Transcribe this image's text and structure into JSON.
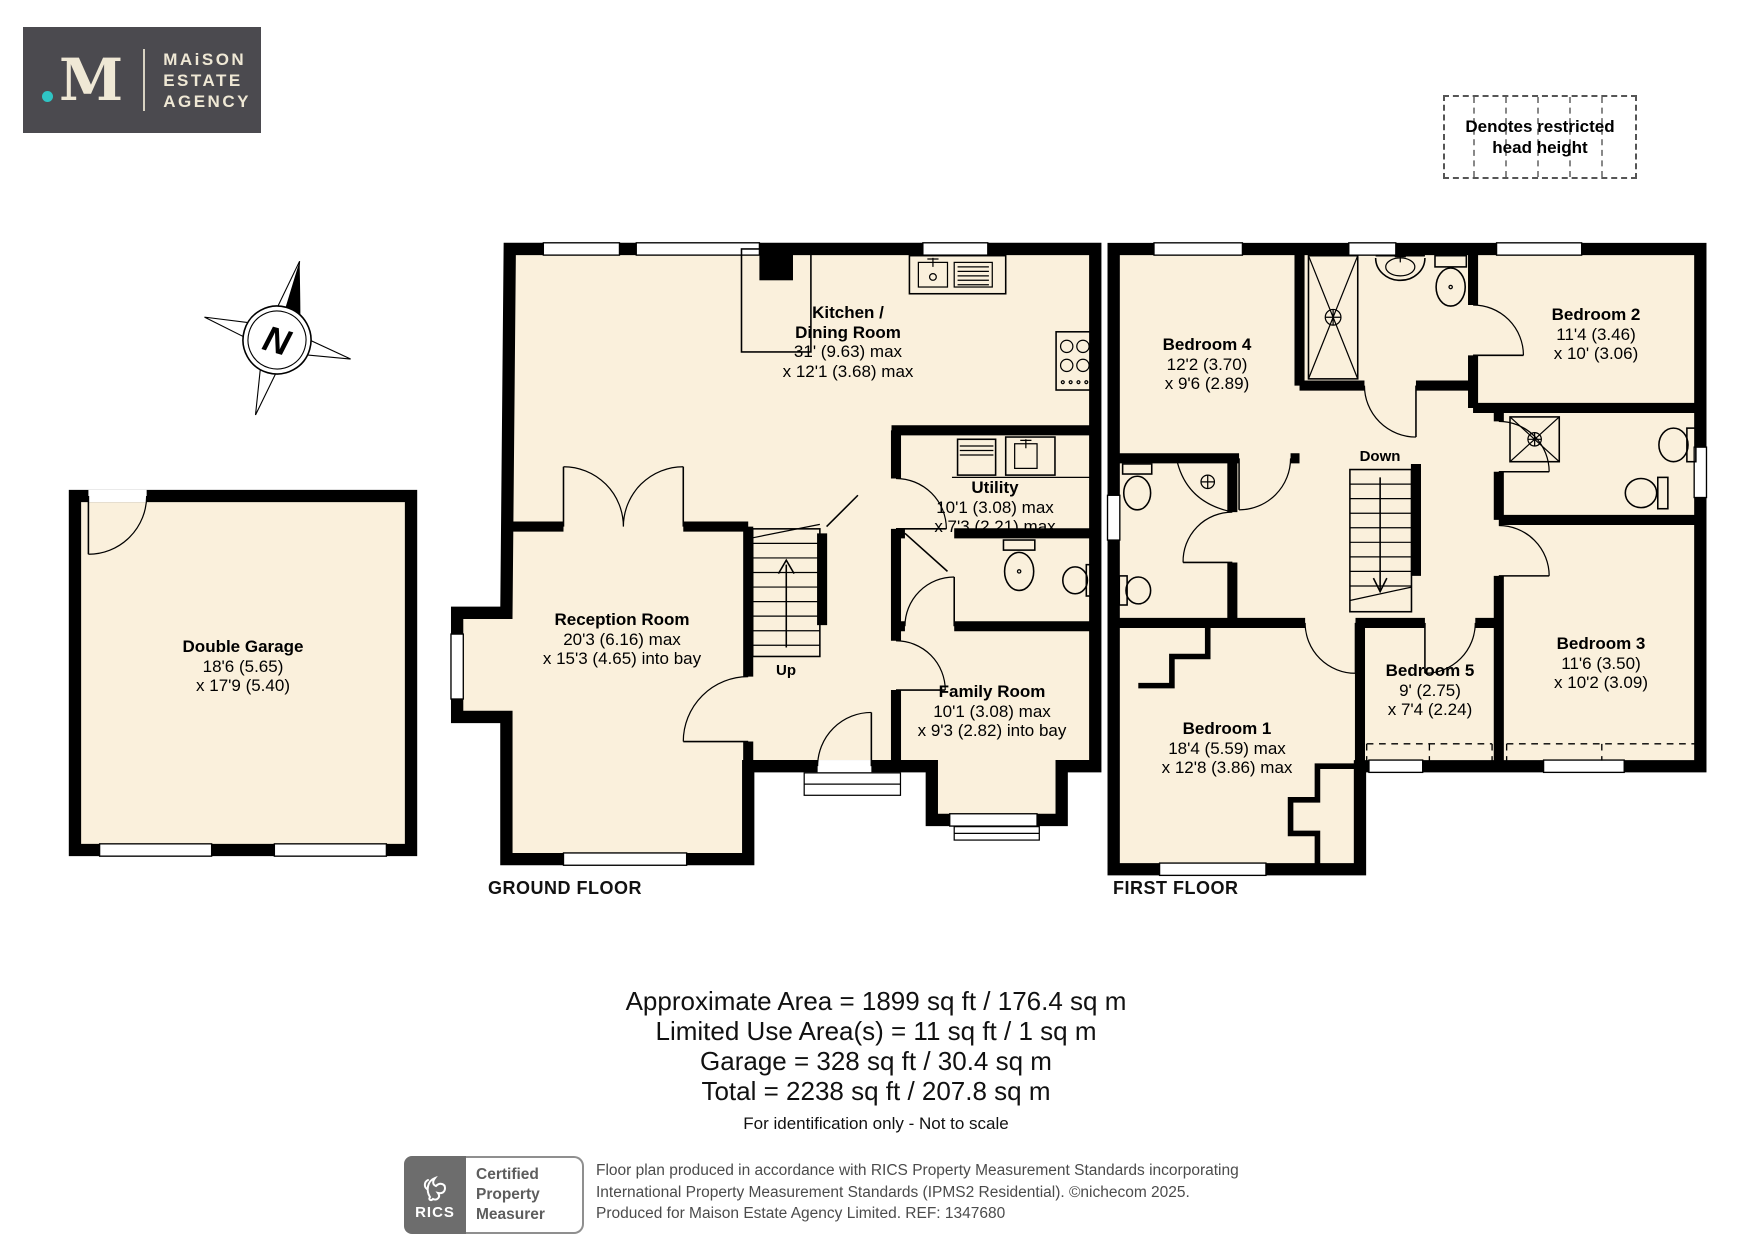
{
  "brand": {
    "dot": ".",
    "mark": "M",
    "line1": "MAiSON",
    "line2": "ESTATE",
    "line3": "AGENCY"
  },
  "legend": {
    "line1": "Denotes restricted",
    "line2": "head height"
  },
  "compass": {
    "north": "N"
  },
  "floors": {
    "garage": {
      "room": {
        "name": "Double Garage",
        "dim1": "18'6 (5.65)",
        "dim2": "x 17'9 (5.40)"
      }
    },
    "ground": {
      "label": "GROUND FLOOR",
      "kitchen": {
        "name1": "Kitchen /",
        "name2": "Dining Room",
        "dim1": "31' (9.63) max",
        "dim2": "x 12'1 (3.68) max"
      },
      "reception": {
        "name": "Reception Room",
        "dim1": "20'3 (6.16) max",
        "dim2": "x 15'3 (4.65) into bay"
      },
      "utility": {
        "name": "Utility",
        "dim1": "10'1 (3.08) max",
        "dim2": "x 7'3 (2.21) max"
      },
      "family": {
        "name": "Family Room",
        "dim1": "10'1 (3.08) max",
        "dim2": "x 9'3 (2.82) into bay"
      },
      "stairs": "Up"
    },
    "first": {
      "label": "FIRST FLOOR",
      "bedroom4": {
        "name": "Bedroom 4",
        "dim1": "12'2 (3.70)",
        "dim2": "x 9'6 (2.89)"
      },
      "bedroom2": {
        "name": "Bedroom 2",
        "dim1": "11'4 (3.46)",
        "dim2": "x 10' (3.06)"
      },
      "bedroom1": {
        "name": "Bedroom 1",
        "dim1": "18'4 (5.59) max",
        "dim2": "x 12'8 (3.86) max"
      },
      "bedroom5": {
        "name": "Bedroom 5",
        "dim1": "9' (2.75)",
        "dim2": "x 7'4 (2.24)"
      },
      "bedroom3": {
        "name": "Bedroom 3",
        "dim1": "11'6 (3.50)",
        "dim2": "x 10'2 (3.09)"
      },
      "stairs": "Down"
    }
  },
  "areas": {
    "line1": "Approximate Area = 1899 sq ft / 176.4 sq m",
    "line2": "Limited Use Area(s) = 11 sq ft / 1 sq m",
    "line3": "Garage = 328 sq ft / 30.4 sq m",
    "line4": "Total = 2238 sq ft / 207.8 sq m",
    "disclaimer": "For identification only - Not to scale"
  },
  "footer": {
    "rics": "RICS",
    "cert1": "Certified",
    "cert2": "Property",
    "cert3": "Measurer",
    "fine1": "Floor plan produced in accordance with RICS Property Measurement Standards incorporating",
    "fine2": "International Property Measurement Standards (IPMS2 Residential).   ©nichecom 2025.",
    "fine3": "Produced for Maison Estate Agency Limited.   REF: 1347680"
  },
  "colors": {
    "room_fill": "#faf0dc",
    "wall": "#000000",
    "brand_bg": "#4b4a4f",
    "brand_cream": "#efe8d5",
    "brand_teal": "#2fc4c4",
    "rics_gray": "#6d6d6d"
  }
}
